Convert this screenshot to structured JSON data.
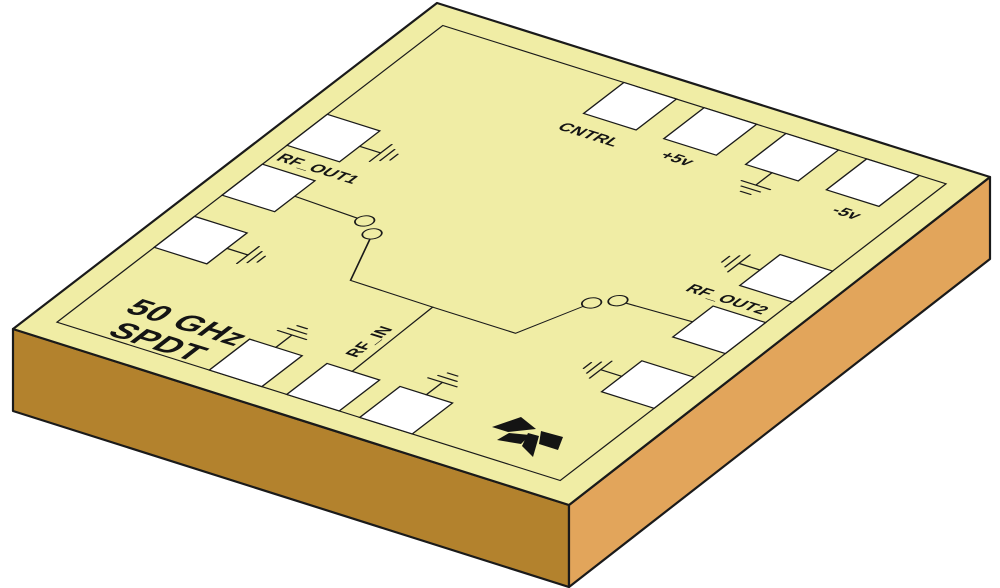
{
  "chip": {
    "title_line1": "50 GHz",
    "title_line2": "SPDT",
    "pad_labels": {
      "cntrl": "CNTRL",
      "plus5v": "+5v",
      "minus5v": "-5v",
      "rf_out1": "RF_OUT1",
      "rf_out2": "RF_OUT2",
      "rf_in": "RF_IN"
    },
    "colors": {
      "top_face": "#f0eda5",
      "side_left": "#b3822d",
      "side_right": "#e2a55b",
      "pad_fill": "#ffffff",
      "outline": "#1a1a1a",
      "text": "#141414",
      "background": "#ffffff"
    }
  }
}
